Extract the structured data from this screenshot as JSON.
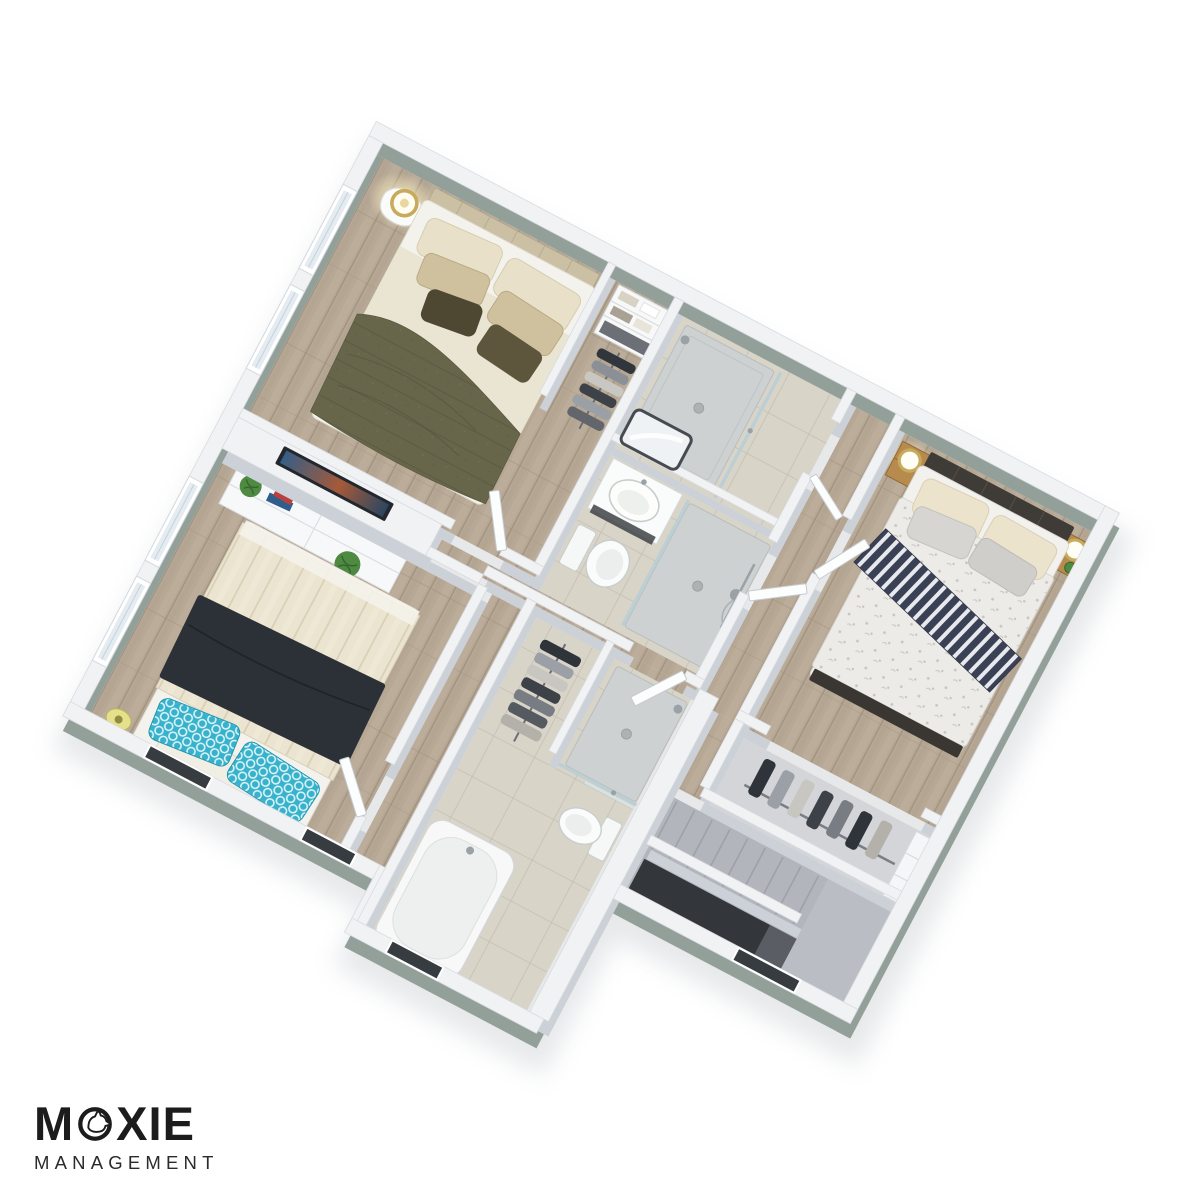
{
  "page": {
    "background": "#ffffff"
  },
  "logo": {
    "word": "MOXIE",
    "word_left": "M",
    "word_right": "XIE",
    "subtitle": "MANAGEMENT",
    "icon": "dog-in-circle-icon",
    "color": "#1c1c1c"
  },
  "floorplan": {
    "type": "3d-isometric-floor-plan",
    "view_rotation_deg": 27.8,
    "palette": {
      "wall_top": "#f1f2f4",
      "wall_edge": "#d8dbe0",
      "wall_side_int": "#ccd1d7",
      "wall_side_ext": "#93a09a",
      "wood_base": "#b7a895",
      "wood_dark": "#9c8d7a",
      "wood_light": "#c6b8a5",
      "tile_base": "#d8d4c8",
      "tile_line": "#c3bfb2",
      "carpet": "#b2b6bc",
      "carpet_line": "#9da1a8",
      "void_dark": "#33373c",
      "glass": "#b9cfd6",
      "chrome": "#9aa2a8",
      "tray": "#cdd1d1",
      "fixture_white": "#fafbfb",
      "fixture_line": "#c9cdcd",
      "duvet_olive": "#67664a",
      "duvet_olive_dark": "#565540",
      "sheet_cream": "#eae5d3",
      "pillow_cream": "#e8e0c8",
      "pillow_tan": "#cfc19e",
      "pillow_olive": "#4e4832",
      "headboard_tan": "#cbbfa4",
      "duvet_floral": "#ecebe7",
      "floral_dot": "#c6c5c0",
      "runner_navy": "#3b4155",
      "runner_white": "#e8e9ee",
      "headboard_dark": "#3f3b37",
      "wood_furn": "#b78a4e",
      "wood_furn_dark": "#8f6a3a",
      "lamp_gold": "#c8ab5a",
      "glow": "#fff3bf",
      "duvet_cream3": "#ebe4d0",
      "channel_line": "#d9d0b6",
      "blanket_navy": "#2c3037",
      "pillow_teal": "#36b2cc",
      "teal_line": "#dff4f8",
      "mattress_white": "#f4f2ec",
      "plant_green": "#4e8a42",
      "plant_dark": "#34652c",
      "tv_dark": "#23272e",
      "dark_opening": "#373c41",
      "shadow": "#b3b9c0",
      "logo_color": "#1c1c1c"
    },
    "rooms": [
      {
        "id": "master-bedroom",
        "items": [
          "double-bed-olive-duvet",
          "tan-headboard",
          "bedside-table",
          "glowing-table-lamp",
          "open-shelf-unit",
          "hanging-clothes-rail",
          "window",
          "window"
        ]
      },
      {
        "id": "shower-room",
        "items": [
          "shower-tray",
          "glass-screen",
          "shower-head"
        ]
      },
      {
        "id": "main-bathroom",
        "items": [
          "vanity-sink",
          "wall-mirror",
          "toilet",
          "walk-in-shower",
          "hand-shower-rail"
        ]
      },
      {
        "id": "bedroom-right",
        "items": [
          "double-bed-floral-duvet",
          "navy-striped-runner",
          "dark-headboard",
          "wood-nightstand-left",
          "wood-nightstand-right",
          "gold-ring-lamp",
          "gold-ring-lamp",
          "plant"
        ]
      },
      {
        "id": "bedroom-right-closet",
        "items": [
          "clothes-rail",
          "hanging-clothes",
          "shelf-unit"
        ]
      },
      {
        "id": "family-bathroom",
        "items": [
          "hanging-clothes-closet",
          "walk-in-shower",
          "toilet",
          "bathtub"
        ]
      },
      {
        "id": "bedroom-left",
        "items": [
          "double-bed-cream-duvet",
          "navy-blanket",
          "teal-patterned-pillows",
          "tv-sideboard",
          "tv",
          "plant",
          "plant",
          "books",
          "yellow-side-tray",
          "window",
          "window"
        ]
      },
      {
        "id": "hallway",
        "items": [
          "open-doors"
        ]
      },
      {
        "id": "staircase",
        "items": [
          "carpet-steps",
          "half-wall",
          "stairwell-void",
          "landing"
        ]
      }
    ]
  }
}
